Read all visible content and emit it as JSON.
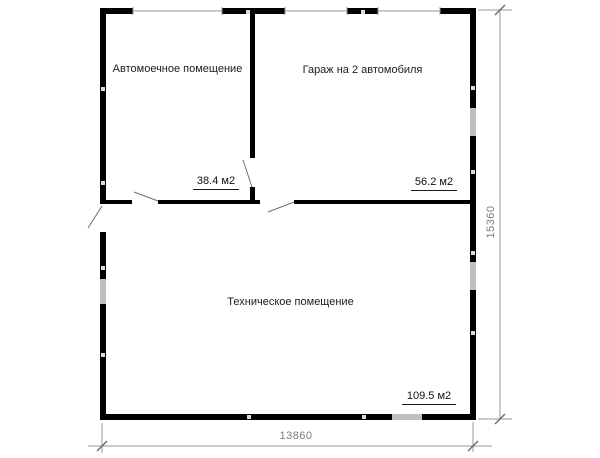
{
  "plan": {
    "rooms": [
      {
        "label": "Автомоечное помещение",
        "area": "38.4 м2"
      },
      {
        "label": "Гараж на 2 автомобиля",
        "area": "56.2 м2"
      },
      {
        "label": "Техническое помещение",
        "area": "109.5 м2"
      }
    ],
    "dimensions": {
      "overall_width": "13860",
      "overall_height": "15360"
    },
    "colors": {
      "wall": "#000000",
      "window_fill": "#bfbfbf",
      "opening_line": "#9a9a9a",
      "door_swing": "#6e6e6e",
      "dimension_line": "#9a9a9a",
      "dimension_tick": "#666666",
      "dimension_text": "#7d7d7d",
      "label_text": "#1c1c1c",
      "background": "#ffffff"
    }
  }
}
